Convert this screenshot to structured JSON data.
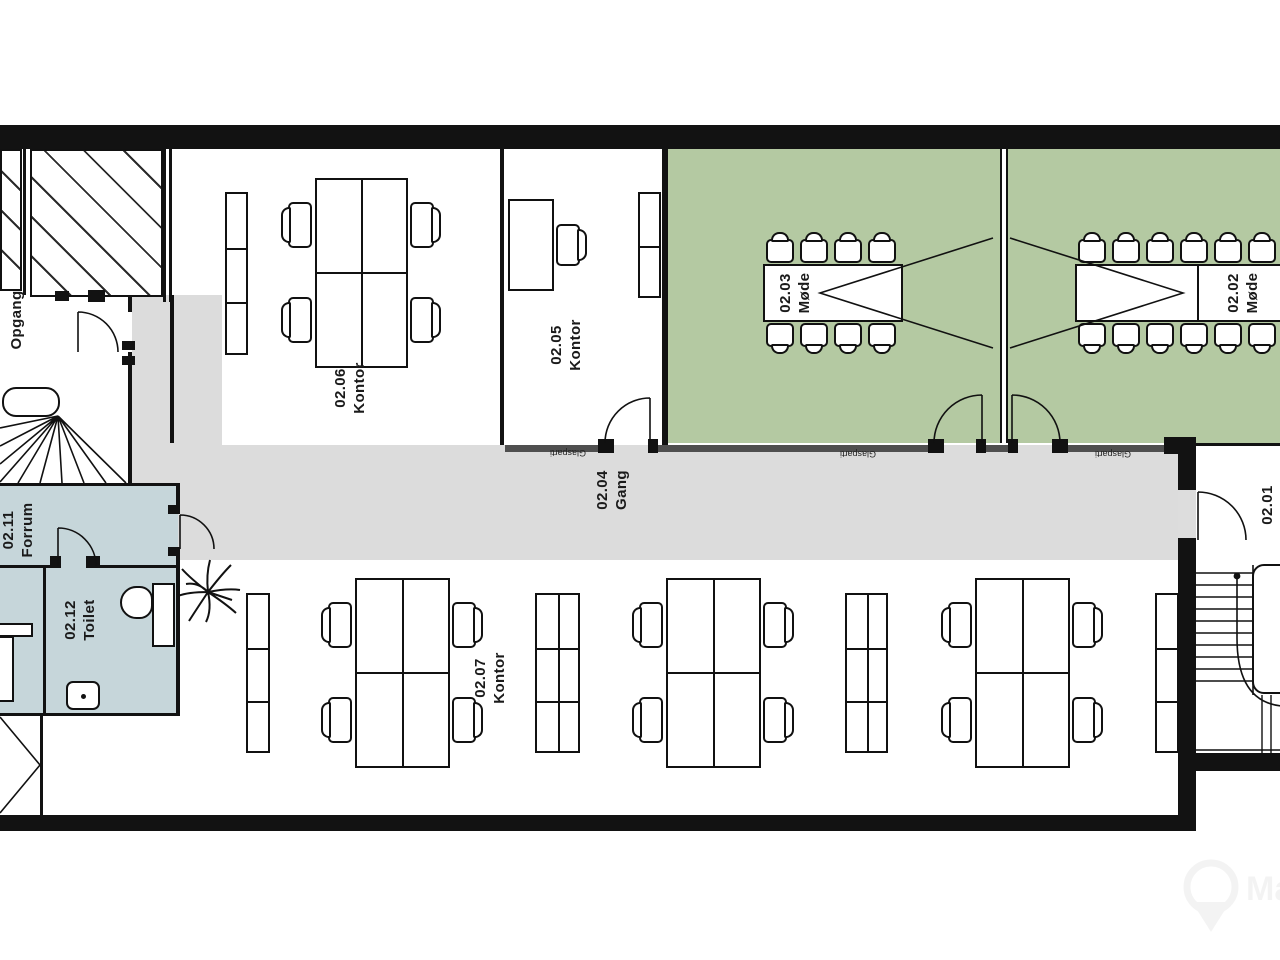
{
  "rooms": {
    "r0201": {
      "number": "02.01",
      "name": ""
    },
    "r0202": {
      "number": "02.02",
      "name": "Møde"
    },
    "r0203": {
      "number": "02.03",
      "name": "Møde"
    },
    "r0204": {
      "number": "02.04",
      "name": "Gang"
    },
    "r0205": {
      "number": "02.05",
      "name": "Kontor"
    },
    "r0206": {
      "number": "02.06",
      "name": "Kontor"
    },
    "r0207": {
      "number": "02.07",
      "name": "Kontor"
    },
    "r0211": {
      "number": "02.11",
      "name": "Forrum"
    },
    "r0212": {
      "number": "02.12",
      "name": "Toilet"
    },
    "stairwell": {
      "name": "Opgang"
    }
  },
  "labels": {
    "glass_partition": "Glasparti"
  },
  "watermark": {
    "text": "Ma"
  },
  "colors": {
    "meeting_room": "#b4c9a2",
    "wet_room": "#c6d6da",
    "corridor": "#dcdcdc",
    "wall": "#121212",
    "glass_wall": "#4f4f4f"
  }
}
